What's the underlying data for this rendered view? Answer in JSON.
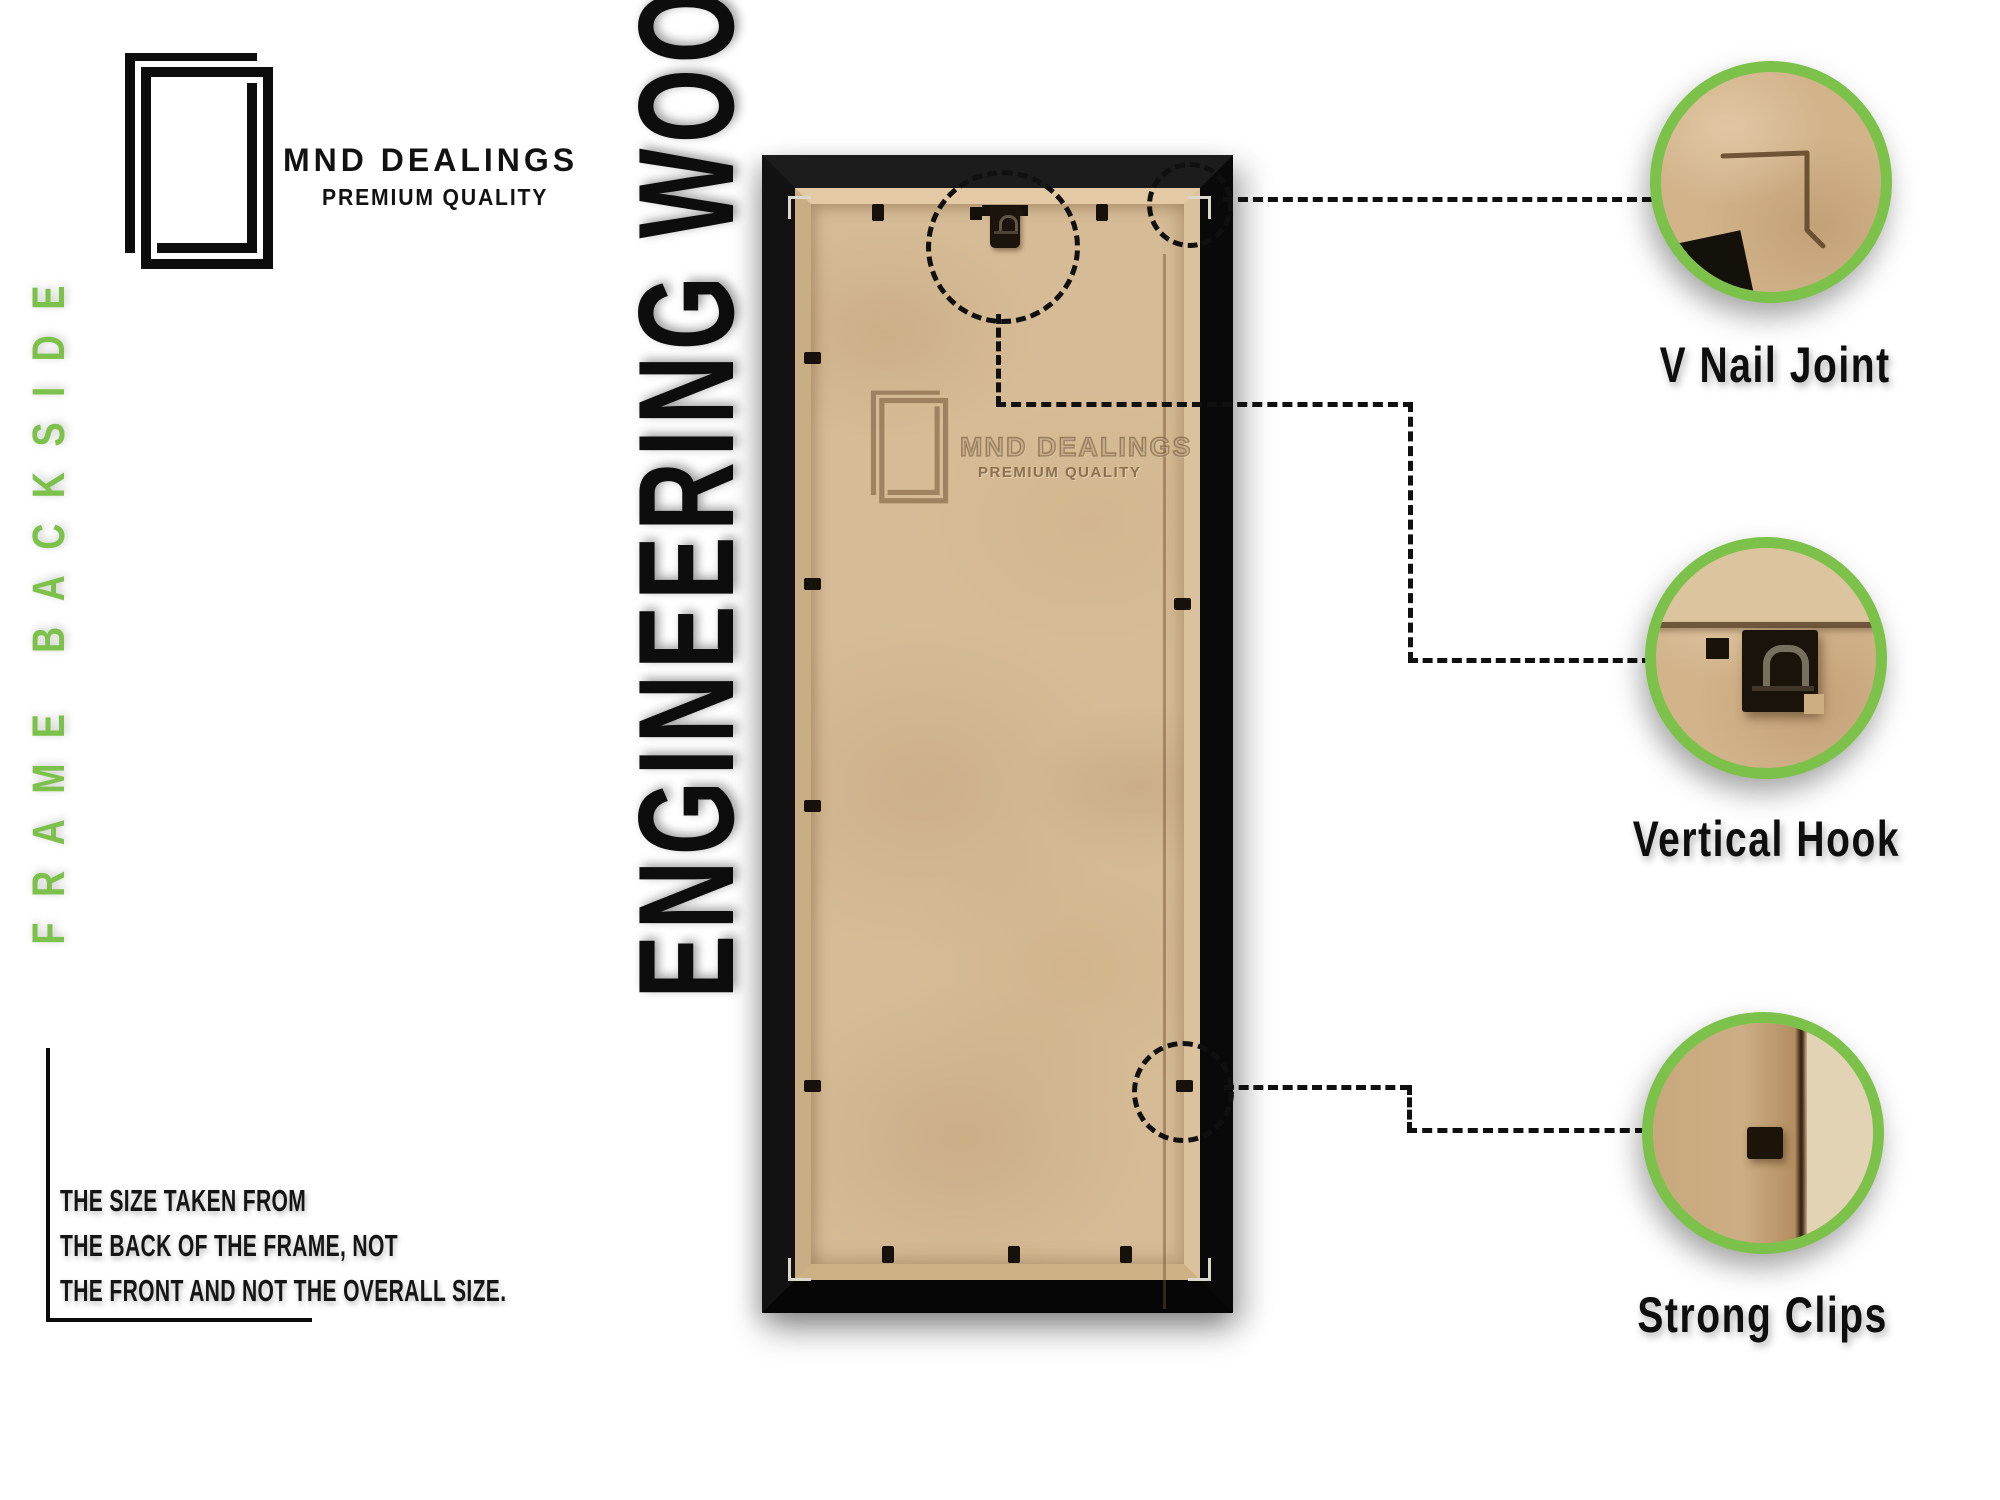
{
  "brand": {
    "name": "MND DEALINGS",
    "tagline": "PREMIUM QUALITY"
  },
  "side_label": "FRAME BACKSIDE",
  "product_label": "ENGINEERING WOOD",
  "size_note": {
    "lines": [
      "THE SIZE TAKEN FROM",
      "THE BACK OF THE FRAME, NOT",
      "THE FRONT AND NOT THE OVERALL SIZE."
    ]
  },
  "watermark": {
    "name": "MND DEALINGS",
    "tagline": "PREMIUM QUALITY"
  },
  "callouts": [
    {
      "label": "V Nail Joint"
    },
    {
      "label": "Vertical Hook"
    },
    {
      "label": "Strong Clips"
    }
  ],
  "colors": {
    "accent_green": "#7cc24a",
    "frame_black": "#141414",
    "board_tan": "#d6bc96",
    "text_black": "#111111"
  }
}
